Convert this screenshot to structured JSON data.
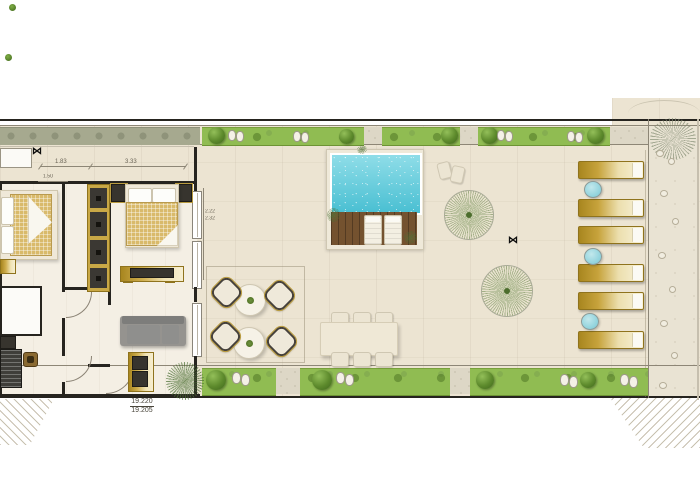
{
  "plan": {
    "type": "penthouse-floor-plan-with-pool-terrace",
    "dim_labels": {
      "w1": "1.83",
      "w2": "3.33",
      "w3": "1.50",
      "h1": "2.22",
      "h2": "2.32"
    },
    "spot_levels": {
      "upper": "19.220",
      "lower": "19.205"
    },
    "icons": {
      "level_marker": "⋈"
    },
    "colors": {
      "pool_water": "#4fc3d6",
      "lawn_green": "#90bc52",
      "gold_furniture": "#c9a846",
      "paving": "#ece4d2",
      "wall": "#26241f",
      "teal_side_table": "#9fd8e0",
      "sofa_gray": "#95938f",
      "bed_tan": "#d9ba6b"
    }
  }
}
